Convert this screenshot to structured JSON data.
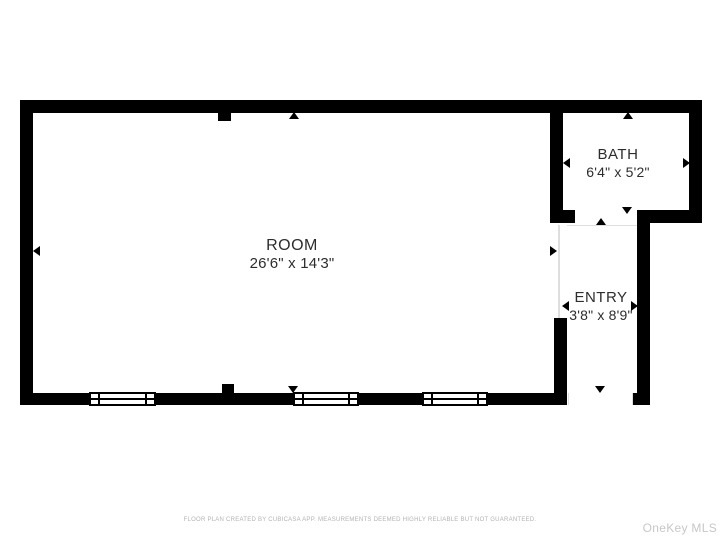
{
  "plan": {
    "rooms": [
      {
        "name": "ROOM",
        "dimensions": "26'6\" x 14'3\""
      },
      {
        "name": "BATH",
        "dimensions": "6'4\" x 5'2\""
      },
      {
        "name": "ENTRY",
        "dimensions": "3'8\" x 8'9\""
      }
    ]
  },
  "footer": {
    "disclaimer": "FLOOR PLAN CREATED BY CUBICASA APP. MEASUREMENTS DEEMED HIGHLY RELIABLE BUT NOT GUARANTEED."
  },
  "watermark": "OneKey MLS",
  "icons": {
    "opening_marker": "small black triangle marking doors/openings",
    "wall_stub": "small black square column on wall"
  },
  "colors": {
    "wall": "#000000",
    "label_text": "#2d2d2d",
    "footer_text": "#b3b3b3",
    "watermark_text": "#c7c7c7",
    "background": "#ffffff",
    "opening_line": "#dedede"
  }
}
